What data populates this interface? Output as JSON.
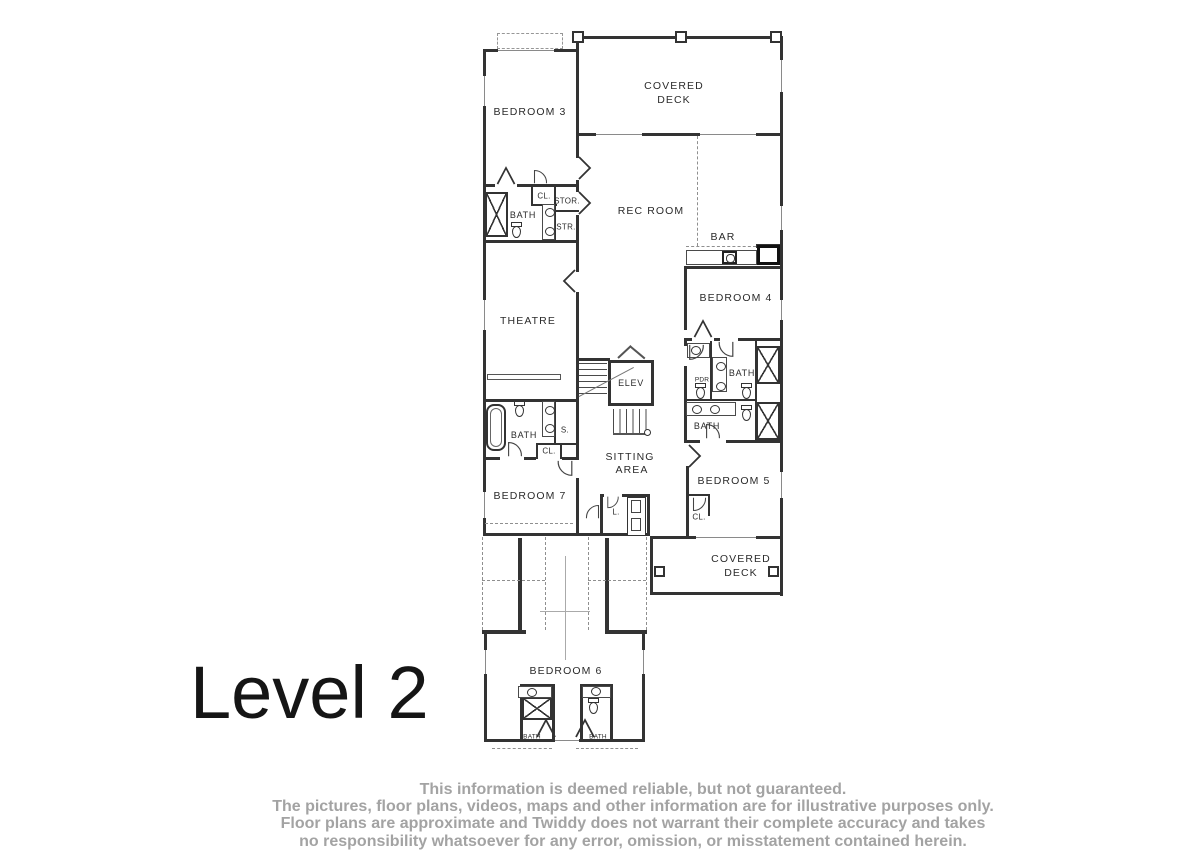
{
  "title": "Level 2",
  "disclaimer": {
    "line1": "This information is deemed reliable, but not guaranteed.",
    "line2": "The pictures, floor plans, videos, maps and other information are for illustrative purposes only.",
    "line3": "Floor plans are approximate and Twiddy does not warrant their complete accuracy and takes",
    "line4": "no responsibility whatsoever for any error, omission, or misstatement contained herein."
  },
  "labels": {
    "bedroom3": "BEDROOM 3",
    "covered_deck_top_1": "COVERED",
    "covered_deck_top_2": "DECK",
    "rec_room": "REC ROOM",
    "bar": "BAR",
    "cl_top": "CL.",
    "stor": "STOR.",
    "bath_top_left": "BATH",
    "str": "STR.",
    "theatre": "THEATRE",
    "bedroom4": "BEDROOM 4",
    "elev": "ELEV",
    "pdr": "PDR",
    "bath_right_upper": "BATH",
    "bath_right_lower": "BATH",
    "bath_left_mid": "BATH",
    "s": "S.",
    "cl_mid": "CL.",
    "sitting_1": "SITTING",
    "sitting_2": "AREA",
    "bedroom7": "BEDROOM 7",
    "l": "L.",
    "bedroom5": "BEDROOM 5",
    "cl_bedroom5": "CL.",
    "covered_deck_bottom_1": "COVERED",
    "covered_deck_bottom_2": "DECK",
    "bedroom6": "BEDROOM 6",
    "bath_bottom_left": "BATH",
    "bath_bottom_right": "BATH"
  },
  "colors": {
    "wall": "#333333",
    "dashed_line": "#8f8f8f",
    "label_text": "#2b2b2b",
    "title_text": "#151515",
    "disclaimer_text": "#a3a3a3"
  }
}
